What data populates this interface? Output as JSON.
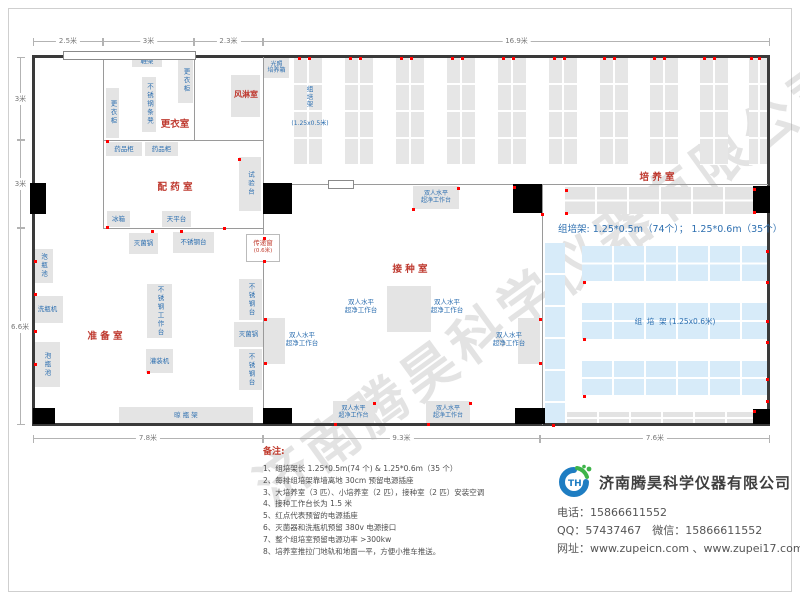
{
  "watermark": "济南腾昊科学仪器有限公司",
  "plan": {
    "walls_dark": [
      [
        33,
        55,
        737,
        3
      ],
      [
        33,
        423,
        737,
        3
      ],
      [
        32,
        55,
        3,
        371
      ],
      [
        767,
        55,
        3,
        371
      ]
    ],
    "walls_light": [
      [
        103,
        57,
        1,
        171
      ],
      [
        194,
        57,
        1,
        84
      ],
      [
        263,
        57,
        1,
        366
      ],
      [
        542,
        185,
        1,
        240
      ],
      [
        103,
        140,
        160,
        1
      ],
      [
        103,
        228,
        160,
        1
      ],
      [
        263,
        184,
        505,
        1
      ]
    ],
    "doors": [
      [
        30,
        183,
        16,
        31
      ],
      [
        263,
        183,
        29,
        31
      ],
      [
        513,
        184,
        29,
        29
      ],
      [
        753,
        186,
        17,
        27
      ],
      [
        33,
        408,
        22,
        16
      ],
      [
        263,
        408,
        29,
        16
      ],
      [
        515,
        408,
        30,
        16
      ],
      [
        753,
        409,
        17,
        15
      ]
    ],
    "windows": [
      [
        63,
        51,
        133,
        9
      ],
      [
        328,
        180,
        26,
        9
      ]
    ],
    "racks_gray_v": [
      [
        294,
        58,
        28,
        107
      ],
      [
        345,
        58,
        28,
        107
      ],
      [
        396,
        58,
        28,
        107
      ],
      [
        447,
        58,
        28,
        107
      ],
      [
        498,
        58,
        28,
        107
      ],
      [
        549,
        58,
        28,
        107
      ],
      [
        600,
        58,
        28,
        107
      ],
      [
        650,
        58,
        28,
        107
      ],
      [
        700,
        58,
        28,
        107
      ],
      [
        749,
        58,
        20,
        107
      ]
    ],
    "bands_gray": [
      [
        565,
        187,
        188,
        27
      ],
      [
        567,
        412,
        186,
        12
      ]
    ],
    "rack_blue_v": [
      545,
      243,
      20,
      180
    ],
    "bands_blue": [
      [
        582,
        246,
        185,
        35
      ],
      [
        582,
        303,
        185,
        36
      ],
      [
        582,
        361,
        185,
        34
      ]
    ],
    "boxes": [
      {
        "t": "鞋架",
        "x": 132,
        "y": 55,
        "w": 30,
        "h": 12
      },
      {
        "t": "更衣柜",
        "x": 178,
        "y": 58,
        "w": 15,
        "h": 45,
        "v": true
      },
      {
        "t": "不锈钢条凳",
        "x": 142,
        "y": 77,
        "w": 14,
        "h": 55,
        "v": true
      },
      {
        "t": "更衣柜",
        "x": 106,
        "y": 88,
        "w": 13,
        "h": 50,
        "v": true
      },
      {
        "t": "",
        "x": 231,
        "y": 75,
        "w": 29,
        "h": 42
      },
      {
        "t": "光照\n培养箱",
        "x": 264,
        "y": 58,
        "w": 25,
        "h": 20,
        "cls": "xs"
      },
      {
        "t": "药品柜",
        "x": 106,
        "y": 142,
        "w": 36,
        "h": 14
      },
      {
        "t": "药品柜",
        "x": 145,
        "y": 142,
        "w": 33,
        "h": 14
      },
      {
        "t": "试验台",
        "x": 239,
        "y": 157,
        "w": 22,
        "h": 54,
        "v": true
      },
      {
        "t": "冰箱",
        "x": 107,
        "y": 211,
        "w": 23,
        "h": 16
      },
      {
        "t": "天平台",
        "x": 162,
        "y": 211,
        "w": 29,
        "h": 16
      },
      {
        "t": "灭菌锅",
        "x": 129,
        "y": 233,
        "w": 29,
        "h": 21
      },
      {
        "t": "不锈钢台",
        "x": 173,
        "y": 232,
        "w": 41,
        "h": 21
      },
      {
        "t": "泡瓶池",
        "x": 33,
        "y": 249,
        "w": 20,
        "h": 34,
        "v": true
      },
      {
        "t": "洗瓶机",
        "x": 32,
        "y": 296,
        "w": 31,
        "h": 27
      },
      {
        "t": "泡瓶池",
        "x": 33,
        "y": 342,
        "w": 27,
        "h": 45,
        "v": true
      },
      {
        "t": "不锈钢工作台",
        "x": 147,
        "y": 284,
        "w": 25,
        "h": 54,
        "v": true
      },
      {
        "t": "灌装机",
        "x": 146,
        "y": 349,
        "w": 27,
        "h": 24
      },
      {
        "t": "不锈钢台",
        "x": 239,
        "y": 279,
        "w": 23,
        "h": 41,
        "v": true
      },
      {
        "t": "灭菌锅",
        "x": 234,
        "y": 322,
        "w": 29,
        "h": 25
      },
      {
        "t": "不锈钢台",
        "x": 239,
        "y": 349,
        "w": 23,
        "h": 41,
        "v": true
      },
      {
        "t": "晾  瓶  架",
        "x": 119,
        "y": 407,
        "w": 134,
        "h": 17
      },
      {
        "t": "双人水平\n超净工作台",
        "x": 413,
        "y": 186,
        "w": 46,
        "h": 23,
        "cls": "xs"
      },
      {
        "t": "",
        "x": 387,
        "y": 286,
        "w": 22,
        "h": 46
      },
      {
        "t": "",
        "x": 409,
        "y": 286,
        "w": 22,
        "h": 46
      },
      {
        "t": "",
        "x": 263,
        "y": 318,
        "w": 22,
        "h": 46
      },
      {
        "t": "",
        "x": 518,
        "y": 318,
        "w": 22,
        "h": 46
      },
      {
        "t": "双人水平\n超净工作台",
        "x": 333,
        "y": 401,
        "w": 41,
        "h": 23,
        "cls": "xs"
      },
      {
        "t": "双人水平\n超净工作台",
        "x": 426,
        "y": 401,
        "w": 44,
        "h": 23,
        "cls": "xs"
      }
    ],
    "texts": [
      {
        "t": "更衣室",
        "x": 152,
        "y": 116,
        "w": 46,
        "cls": "room"
      },
      {
        "t": "风淋室",
        "x": 227,
        "y": 89,
        "w": 38,
        "cls": "room rs"
      },
      {
        "t": "配 药 室",
        "x": 144,
        "y": 179,
        "w": 62,
        "cls": "room"
      },
      {
        "t": "准 备 室",
        "x": 74,
        "y": 328,
        "w": 62,
        "cls": "room"
      },
      {
        "t": "接 种 室",
        "x": 379,
        "y": 261,
        "w": 62,
        "cls": "room"
      },
      {
        "t": "培 养 室",
        "x": 626,
        "y": 169,
        "w": 62,
        "cls": "room"
      },
      {
        "t": "双人水平\n超净工作台",
        "x": 342,
        "y": 299,
        "w": 38,
        "cls": "blue"
      },
      {
        "t": "双人水平\n超净工作台",
        "x": 428,
        "y": 299,
        "w": 38,
        "cls": "blue"
      },
      {
        "t": "双人水平\n超净工作台",
        "x": 283,
        "y": 332,
        "w": 38,
        "cls": "blue"
      },
      {
        "t": "双人水平\n超净工作台",
        "x": 490,
        "y": 332,
        "w": 38,
        "cls": "blue"
      },
      {
        "t": "组\n培\n架",
        "x": 302,
        "y": 86,
        "w": 16,
        "cls": "blue"
      },
      {
        "t": "(1.25x0.5米)",
        "x": 285,
        "y": 118,
        "w": 50,
        "cls": "bluexs"
      },
      {
        "t": "组  培  架 (1.25x0.6米)",
        "x": 600,
        "y": 316,
        "w": 150,
        "cls": "blue8"
      },
      {
        "t": "组培架: 1.25*0.5m（74个）； 1.25*0.6m（35个）",
        "x": 558,
        "y": 221,
        "w": 212,
        "cls": "title-blue"
      }
    ],
    "transfer_window": {
      "t": "传递窗",
      "s": "(0.6米)",
      "x": 246,
      "y": 234,
      "w": 34,
      "h": 28
    },
    "red_dots": [
      [
        298,
        57
      ],
      [
        308,
        57
      ],
      [
        349,
        57
      ],
      [
        359,
        57
      ],
      [
        400,
        57
      ],
      [
        410,
        57
      ],
      [
        451,
        57
      ],
      [
        461,
        57
      ],
      [
        502,
        57
      ],
      [
        512,
        57
      ],
      [
        553,
        57
      ],
      [
        563,
        57
      ],
      [
        603,
        57
      ],
      [
        613,
        57
      ],
      [
        653,
        57
      ],
      [
        663,
        57
      ],
      [
        703,
        57
      ],
      [
        713,
        57
      ],
      [
        750,
        57
      ],
      [
        758,
        57
      ],
      [
        766,
        250
      ],
      [
        766,
        281
      ],
      [
        766,
        320
      ],
      [
        766,
        341
      ],
      [
        766,
        378
      ],
      [
        766,
        400
      ],
      [
        34,
        260
      ],
      [
        34,
        293
      ],
      [
        34,
        330
      ],
      [
        34,
        363
      ],
      [
        151,
        230
      ],
      [
        180,
        230
      ],
      [
        263,
        237
      ],
      [
        263,
        260
      ],
      [
        147,
        371
      ],
      [
        334,
        423
      ],
      [
        373,
        402
      ],
      [
        427,
        423
      ],
      [
        469,
        402
      ],
      [
        412,
        208
      ],
      [
        457,
        187
      ],
      [
        264,
        318
      ],
      [
        264,
        362
      ],
      [
        539,
        318
      ],
      [
        539,
        362
      ],
      [
        513,
        186
      ],
      [
        541,
        213
      ],
      [
        753,
        188
      ],
      [
        753,
        211
      ],
      [
        106,
        140
      ],
      [
        106,
        226
      ],
      [
        238,
        158
      ],
      [
        223,
        227
      ],
      [
        565,
        189
      ],
      [
        565,
        212
      ],
      [
        753,
        410
      ],
      [
        583,
        281
      ],
      [
        583,
        338
      ],
      [
        583,
        395
      ],
      [
        552,
        424
      ]
    ],
    "dims_top": {
      "y": 41,
      "segs": [
        {
          "t": "2.5米",
          "x1": 33,
          "x2": 103
        },
        {
          "t": "3米",
          "x1": 103,
          "x2": 194
        },
        {
          "t": "2.3米",
          "x1": 194,
          "x2": 263
        },
        {
          "t": "16.9米",
          "x1": 263,
          "x2": 770
        }
      ]
    },
    "dims_bottom": {
      "y": 438,
      "segs": [
        {
          "t": "7.8米",
          "x1": 33,
          "x2": 263
        },
        {
          "t": "9.3米",
          "x1": 263,
          "x2": 540
        },
        {
          "t": "7.6米",
          "x1": 540,
          "x2": 770
        }
      ]
    },
    "dims_left": {
      "x": 20,
      "segs": [
        {
          "t": "3米",
          "y1": 57,
          "y2": 140
        },
        {
          "t": "3米",
          "y1": 140,
          "y2": 228
        },
        {
          "t": "6.6米",
          "y1": 228,
          "y2": 425
        }
      ]
    }
  },
  "notes": {
    "title": "备注:",
    "items": [
      "1、组培架长 1.25*0.5m(74 个) & 1.25*0.6m（35 个）",
      "2、每排组培架靠墙离地 30cm 预留电源插座",
      "3、大培养室（3 匹）、小培养室（2 匹），接种室（2 匹）安装空调",
      "4、接种工作台长为 1.5 米",
      "5、红点代表预留的电源插座",
      "6、灭菌器和洗瓶机预留 380v 电源接口",
      "7、整个组培室预留电源功率 >300kw",
      "8、培养室推拉门地轨和地面一平，方便小推车推送。"
    ]
  },
  "company": {
    "name": "济南腾昊科学仪器有限公司",
    "lines": [
      "电话：15866611552",
      "QQ：57437467　微信：15866611552",
      "网址：www.zupeicn.com 、www.zupei17.com"
    ],
    "logo_blue": "#1e7dc2",
    "logo_green": "#3eb44a"
  }
}
